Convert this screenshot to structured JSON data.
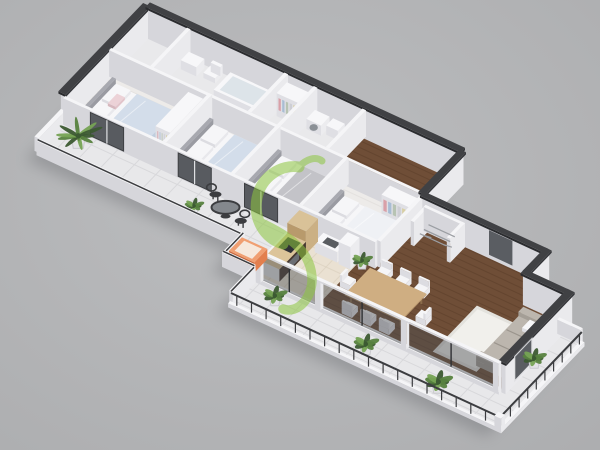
{
  "scene": {
    "type": "isometric-3d-floor-plan-render",
    "watermark": {
      "name": "green-ribbon-logo",
      "color": "#8dc63f",
      "opacity": 0.55
    }
  },
  "palette": {
    "background_center": "#bcbdbf",
    "background_edge": "#adaeb0",
    "shadow": "#55565c",
    "wall_top": "#f5f5f7",
    "wall_face_right": "#eaeaed",
    "wall_face_left": "#d6d6db",
    "wall_dark_top": "#404144",
    "wall_dark_right": "#343539",
    "wall_dark_left": "#2b2c2f",
    "fixture_top": "#f7f7f9",
    "fixture_right": "#ececef",
    "fixture_left": "#dfdfe4",
    "floor_bath": "#e9e9eb",
    "floor_light": "#edebe9",
    "floor_light_line": "#e0ddda",
    "floor_wood": "#6f4e37",
    "floor_wood_line": "#5b3e2a",
    "floor_kitchen": "#eae1d2",
    "floor_kitchen_line": "#dcd2c0",
    "floor_tile": "#e8e8ea",
    "floor_tile_line": "#d8d8db",
    "headboard_top": "#a8a9b0",
    "headboard_right": "#9a9ba2",
    "headboard_left": "#8d8e95",
    "bed_top": "#f6f6f8",
    "bed_right": "#e8e8ec",
    "bed_left": "#dcdce1",
    "blanket_blue": "#d3ddea",
    "blanket_blue_dark": "#bfcede",
    "blanket_gray": "#c3c3c8",
    "blanket_gray_dark": "#b2b2b8",
    "duvet_white": "#eff1f5",
    "duvet_white_dark": "#e2e5eb",
    "pillow_pink": "#ecd2d7",
    "clothes": [
      "#d9a0a8",
      "#a9bdd4",
      "#b7c3b3",
      "#cdced4",
      "#d8cfa5"
    ],
    "sofa_top": "#bcb6ae",
    "sofa_right": "#b0aaa2",
    "sofa_left": "#a49e96",
    "sofa_line": "#9b958d",
    "rug": "#f1f0ec",
    "rug_line": "#e3e2dd",
    "table_top": "#cfae82",
    "table_right": "#c09e72",
    "table_left": "#b08e62",
    "table_leg": "#8a6b4a",
    "chair_top": "#f5f5f7",
    "chair_right": "#e9e9ed",
    "chair_left": "#dcdce1",
    "counter_top": "#dcc49a",
    "cabinet_dark": "#463830",
    "cabinet_panel": "#6b6e73",
    "wood_cab_top": "#d9c298",
    "wood_cab_right": "#cbb084",
    "wood_cab_left": "#b89a6c",
    "appliance": "#303136",
    "sink": "#595c60",
    "washer_door": "#8b9096",
    "glass": "#4b4e53",
    "frame": "#2e3033",
    "mullion": "#dfe0e3",
    "metal": "#3c3d40",
    "rack": "#9b9ea3",
    "plant_dark": "#3c5a32",
    "plant_mid": "#57823f",
    "plant_light": "#76a354",
    "pot": "#e3e3e6",
    "pot_shade": "#c9c9ce",
    "soil": "#6b4f3c",
    "orange_top": "#f09f72",
    "orange_right": "#e37f4e",
    "orange_left": "#c9683c",
    "orange_inner": "#f6e8dc"
  },
  "rooms": [
    {
      "id": "bathroom-1",
      "furniture": [
        "bathtub",
        "toilet",
        "vanity"
      ]
    },
    {
      "id": "hall-closet",
      "furniture": [
        "wardrobe-with-clothes"
      ]
    },
    {
      "id": "bathroom-2",
      "furniture": [
        "washing-machine",
        "washbasin",
        "toilet"
      ]
    },
    {
      "id": "corridor",
      "furniture": []
    },
    {
      "id": "bedroom-master",
      "furniture": [
        "double-bed",
        "wardrobe"
      ]
    },
    {
      "id": "bedroom-2",
      "furniture": [
        "double-bed"
      ]
    },
    {
      "id": "bedroom-3",
      "furniture": [
        "double-bed",
        "dresser"
      ]
    },
    {
      "id": "bedroom-4",
      "furniture": [
        "double-bed",
        "wardrobe"
      ]
    },
    {
      "id": "balcony-walkway",
      "furniture": [
        "palm-plant",
        "bistro-table",
        "bistro-chairs",
        "shrub",
        "orange-planter-box"
      ]
    },
    {
      "id": "kitchen",
      "furniture": [
        "bar-counter",
        "cooktop",
        "tall-cabinet",
        "counter-with-sink",
        "fridge"
      ]
    },
    {
      "id": "dining-area",
      "furniture": [
        "dining-table",
        "eight-chairs",
        "plant"
      ]
    },
    {
      "id": "living-room",
      "furniture": [
        "sofa",
        "rug"
      ]
    },
    {
      "id": "entrance-hall",
      "furniture": [
        "utility-room",
        "drying-rack"
      ]
    },
    {
      "id": "terrace",
      "furniture": [
        "potted-plants",
        "railings"
      ]
    }
  ]
}
